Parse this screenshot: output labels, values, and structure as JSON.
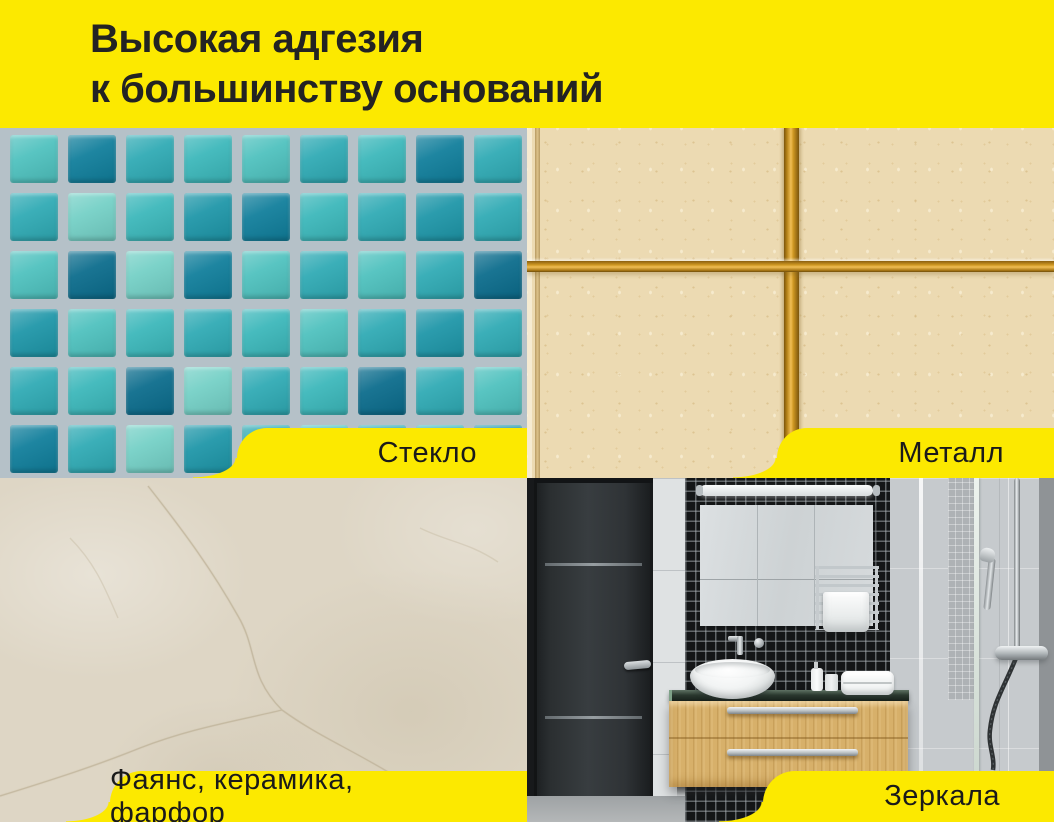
{
  "header": {
    "title_line1": "Высокая адгезия",
    "title_line2": "к большинству оснований"
  },
  "tabs": {
    "glass": "Стекло",
    "metal": "Металл",
    "ceramic": "Фаянс, керамика, фарфор",
    "mirror": "Зеркала"
  },
  "colors": {
    "yellow": "#FCE900",
    "title-color": "#232323",
    "label-color": "#1A1A1A",
    "mosaic-grout": "#B5C1C8",
    "metal-tile": "#ECDAB2",
    "gold-dark": "#7A540D",
    "gold-mid": "#CE9722",
    "gold-light": "#F0BE55",
    "ceramic-base": "#DED6C5",
    "crack": "#BFB39A"
  },
  "mosaic": {
    "palette": {
      "l": "#4EC1BE",
      "m": "#2FAAB4",
      "t": "#1E96A8",
      "d": "#107E9B",
      "e": "#0B6C8C",
      "p": "#74D0C6",
      "g": "#3BB7BA"
    },
    "rows": [
      "ldmglmgdm",
      "mpgtdgmtm",
      "lepdlmlme",
      "tlgmglmtm",
      "mgepmgeml",
      "dmptmlmgt"
    ]
  }
}
